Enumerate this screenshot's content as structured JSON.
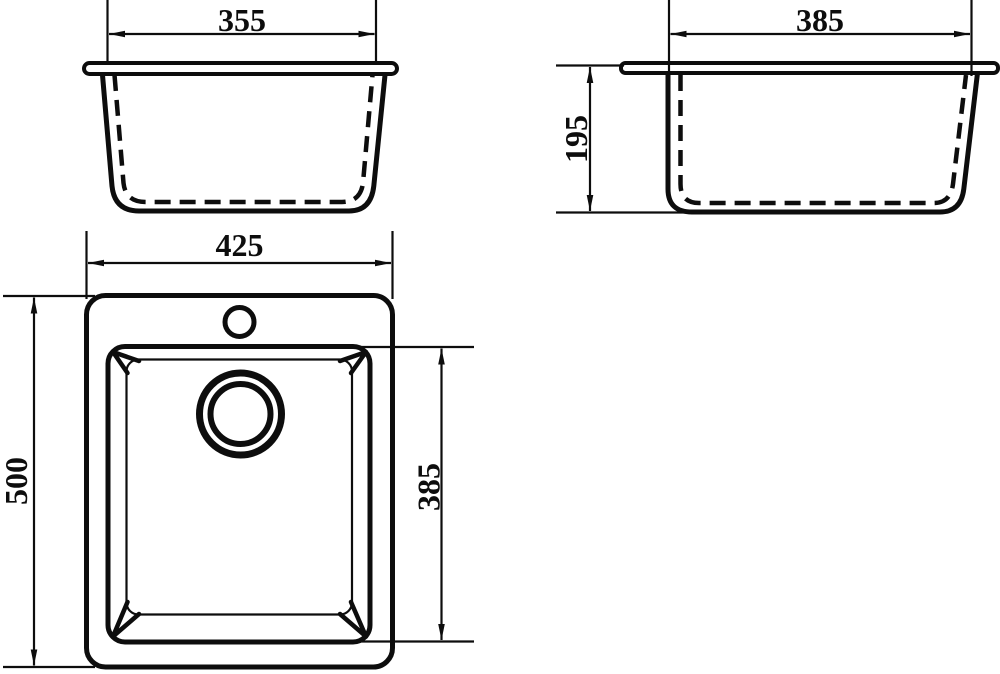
{
  "drawing": {
    "background_color": "#ffffff",
    "line_color": "#0d0d0d",
    "front_view": {
      "width_dim": "355"
    },
    "side_view": {
      "width_dim": "385",
      "depth_dim": "195"
    },
    "plan_view": {
      "width_dim": "425",
      "length_dim": "500",
      "bowl_length_dim": "385"
    }
  }
}
